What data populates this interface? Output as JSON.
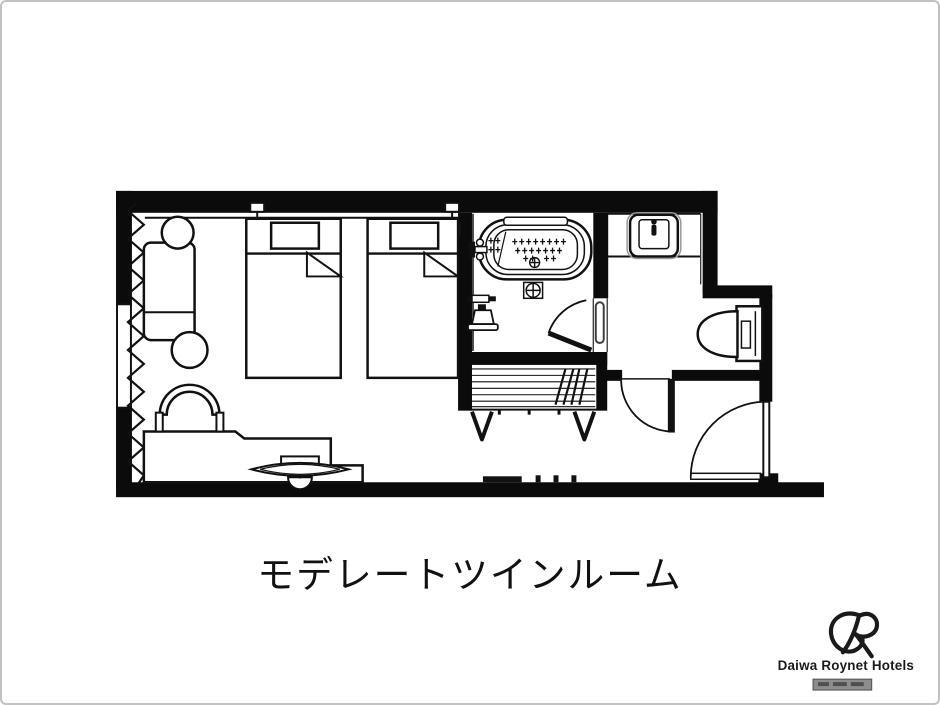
{
  "page": {
    "background": "#ffffff",
    "border_color": "#c2c2c2"
  },
  "caption": {
    "text": "モデレートツインルーム"
  },
  "branding": {
    "name": "Daiwa Roynet Hotels",
    "monogram": "R"
  },
  "palette": {
    "wall": "#0b0b0b",
    "line": "#111111",
    "fixture_fill": "#ffffff",
    "handle_gray": "#3f3f3f",
    "watermark_bar": "#8d8d8d",
    "watermark_marks": "#4f4f4f"
  },
  "floor_plan": {
    "room_label": "モデレートツインルーム",
    "elements": [
      "window-curtain",
      "sofa",
      "round-side-table-top",
      "round-side-table-bottom",
      "twin-bed-1",
      "twin-bed-2",
      "pillow-1",
      "pillow-2",
      "wall-reading-lamp-1",
      "wall-reading-lamp-2",
      "desk",
      "desk-chair",
      "tv-on-swivel-stand",
      "luggage-bench",
      "bathtub",
      "tub-faucet",
      "hand-shower",
      "floor-drain",
      "tub-drain",
      "bathroom-door",
      "bathroom-door-handle",
      "washbasin-counter",
      "washbasin",
      "basin-faucet",
      "toilet",
      "toilet-tank",
      "toilet-door",
      "entrance-door",
      "door-threshold"
    ]
  }
}
